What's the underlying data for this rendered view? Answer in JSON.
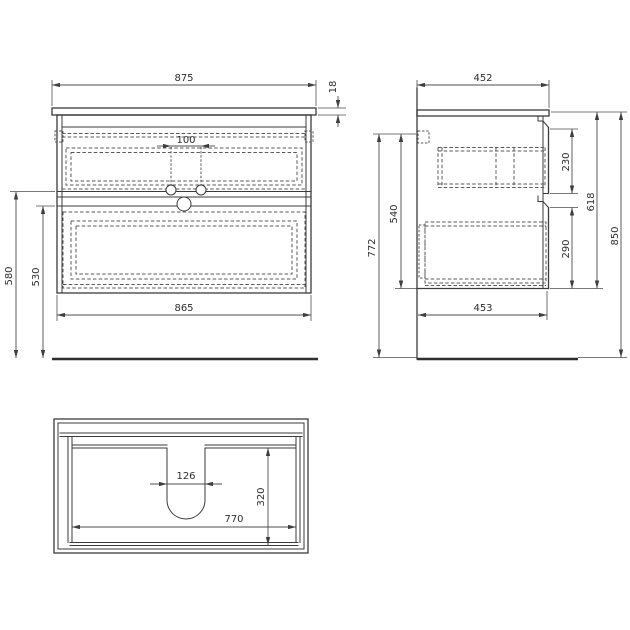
{
  "drawing": {
    "background": "#ffffff",
    "line_color": "#3b3b3b",
    "front_view": {
      "dims": {
        "top_width": "875",
        "countertop_thickness": "18",
        "hole_spacing": "100",
        "left_outer_height": "580",
        "left_inner_height": "530",
        "bottom_width": "865"
      }
    },
    "side_view": {
      "dims": {
        "top_depth": "452",
        "upper_drawer_front": "230",
        "inner_height": "540",
        "body_height": "618",
        "lower_drawer_front": "290",
        "mount_height": "772",
        "total_height": "850",
        "bottom_depth": "453"
      }
    },
    "plan_view": {
      "dims": {
        "cutout_width": "126",
        "inner_depth": "320",
        "inner_width": "770"
      }
    }
  }
}
